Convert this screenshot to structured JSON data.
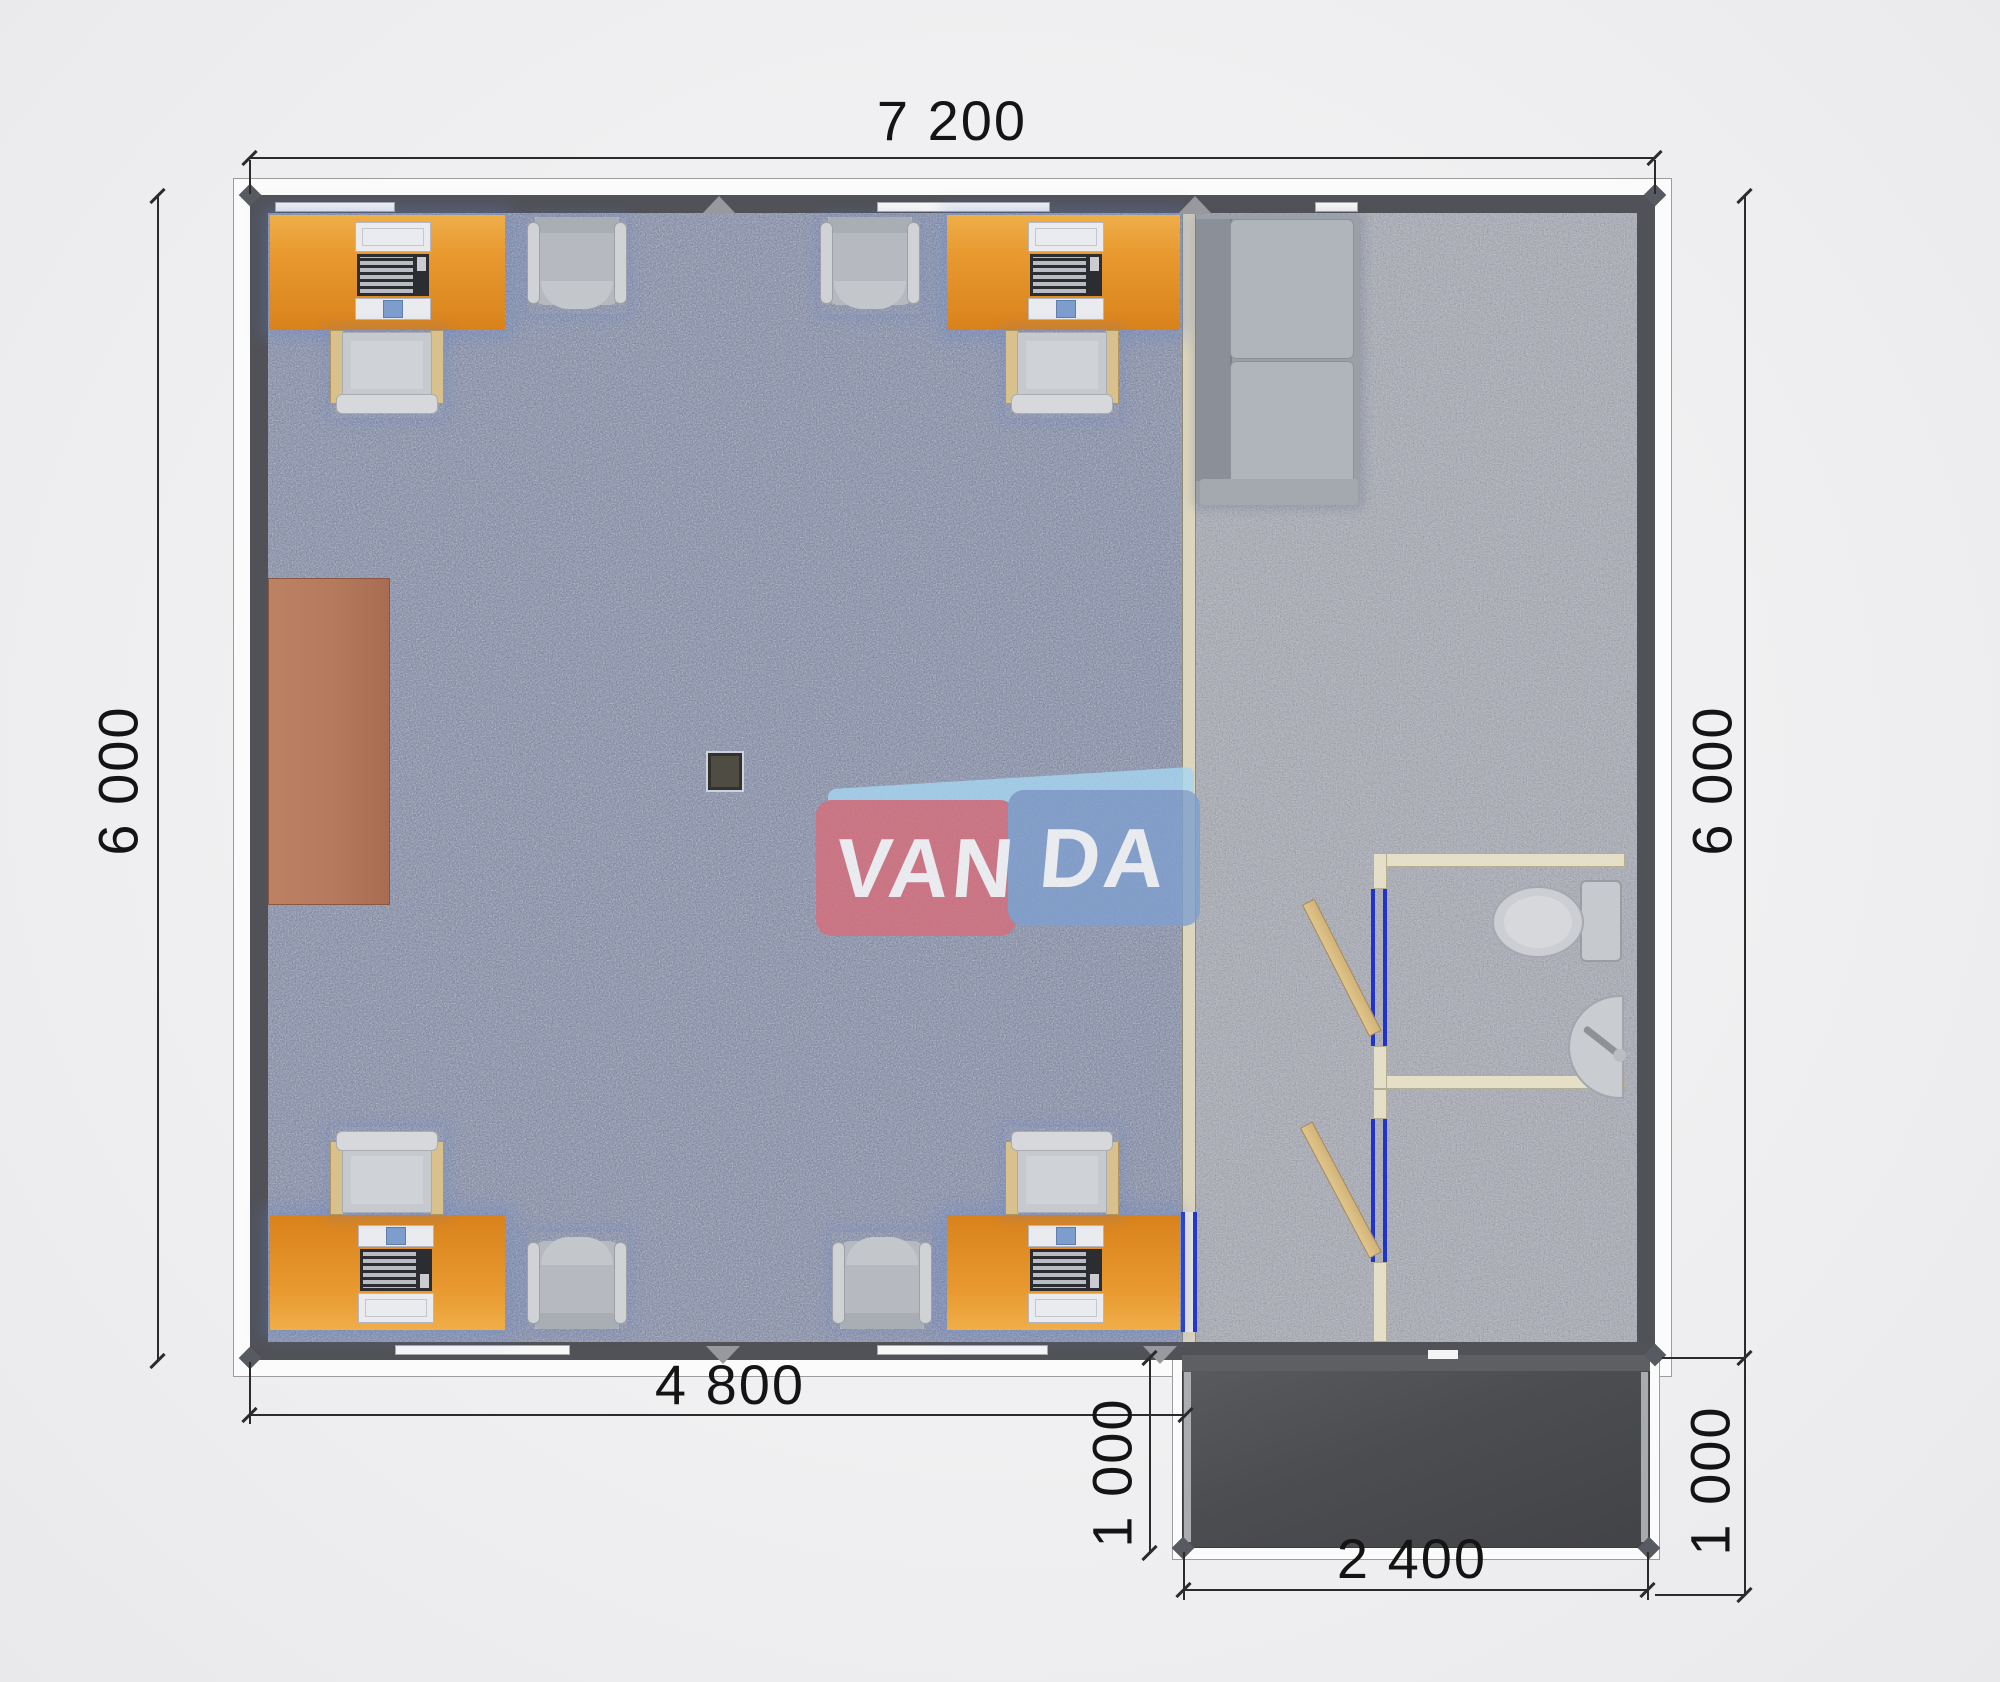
{
  "watermark": {
    "van": "VAN",
    "da": "DA"
  },
  "dimensions": {
    "top": "7 200",
    "left": "6 000",
    "right": "6 000",
    "bottom_left": "4 800",
    "porch_left": "1 000",
    "porch_right": "1 000",
    "porch_bottom": "2 400"
  },
  "colors": {
    "wall": "#515257",
    "divider": "#ddd6bf",
    "desk": "#e8992f",
    "desk-dark": "#d9821c",
    "chair-frame": "#d9c18d",
    "seat": "#c6c9cd",
    "armchair": "#b6b9bf",
    "sofa": "#9aa0a8",
    "cushion": "#b0b4bb",
    "cabinet": "#b57a5e",
    "cream": "#e6dfc7",
    "door-frame-blue": "#2233cc",
    "door-tan": "#d2b378",
    "porch": "#4c4d51",
    "dim-line": "#2b2b2b",
    "dim-text": "#141414",
    "window": "#f7f7f7",
    "column": "#4f4c43",
    "logo-red": "#d76d7b",
    "logo-blue": "#7fa0cf",
    "logo-bevel": "#a6d6f2"
  }
}
